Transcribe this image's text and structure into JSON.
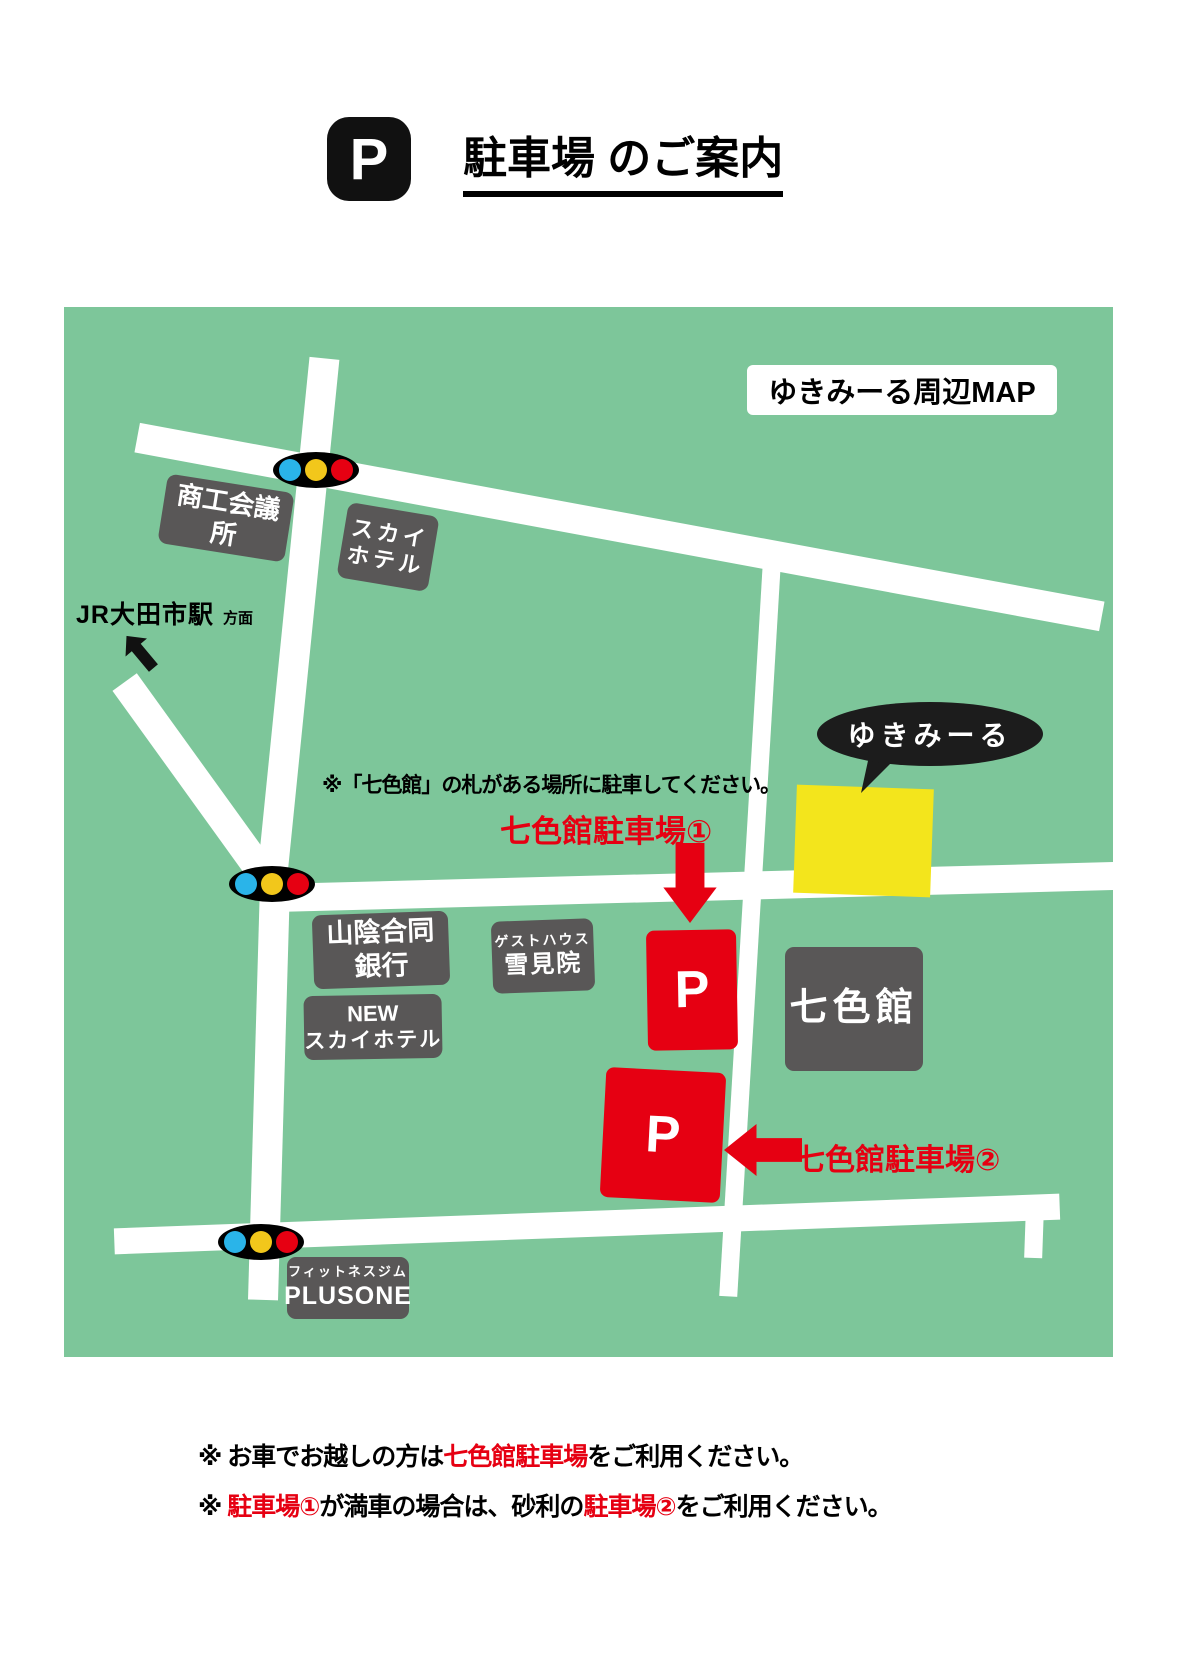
{
  "colors": {
    "map_green": "#7dc69a",
    "building_gray": "#595757",
    "accent_red": "#e60012",
    "highlight_yellow": "#f3e51c",
    "signal_blue": "#2ab4e9",
    "signal_yellow": "#f2c71b",
    "signal_red": "#e60012",
    "road_white": "#ffffff",
    "ink_black": "#111111"
  },
  "header": {
    "badge": "P",
    "title": "駐車場 のご案内"
  },
  "map": {
    "title_label": "ゆきみーる周辺MAP",
    "bubble_label": "ゆきみーる",
    "jr_station": "JR大田市駅",
    "jr_direction": "方面",
    "parking_note": "※「七色館」の札がある場所に駐車してください。",
    "parking1_label": "七色館駐車場①",
    "parking2_label": "七色館駐車場②",
    "parking_symbol": "P",
    "buildings": {
      "chamber_of_commerce": "商工会議所",
      "sky_hotel_line1": "スカイ",
      "sky_hotel_line2": "ホテル",
      "bank_line1": "山陰合同",
      "bank_line2": "銀行",
      "guesthouse_line1": "ゲストハウス",
      "guesthouse_line2": "雪見院",
      "new_sky_hotel_line1": "NEW",
      "new_sky_hotel_line2": "スカイホテル",
      "nanairokan": "七色館",
      "fitness_line1": "フィットネスジム",
      "fitness_line2": "PLUSONE"
    }
  },
  "footer": {
    "line1_seg1": "※ お車でお越しの方は",
    "line1_seg2": "七色館駐車場",
    "line1_seg3": "をご利用ください。",
    "line2_seg1": "※ ",
    "line2_seg2": "駐車場①",
    "line2_seg3": "が満車の場合は、砂利の",
    "line2_seg4": "駐車場②",
    "line2_seg5": "をご利用ください。"
  }
}
